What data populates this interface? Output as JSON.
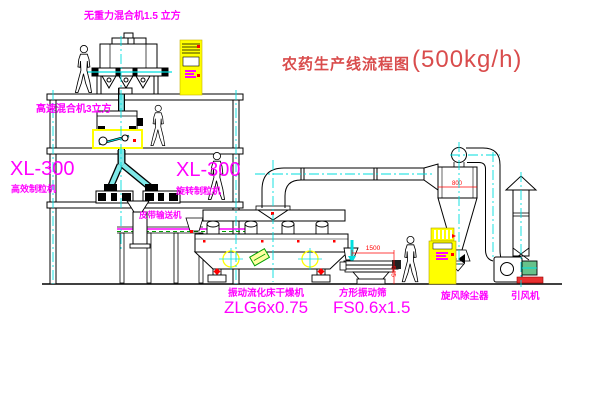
{
  "title": {
    "zh": "农药生产线流程图",
    "capacity": "(500kg/h)"
  },
  "labels": {
    "mixer_top": "无重力混合机1.5 立方",
    "mixer_floor2": "高速混合机3立方",
    "granulator_left_model": "XL-300",
    "granulator_left_name": "高效制粒机",
    "granulator_right_model": "XL-300",
    "granulator_right_name": "旋转制粒机",
    "belt_conveyor": "皮带输送机",
    "dryer_name": "振动流化床干燥机",
    "dryer_model": "ZLG6x0.75",
    "screen_name": "方形振动筛",
    "screen_model": "FS0.6x1.5",
    "cyclone_name": "旋风除尘器",
    "fan_name": "引风机"
  },
  "dimensions": {
    "screen_length": "1500",
    "screen_height": "545",
    "cyclone_dia": "800"
  },
  "colors": {
    "label_magenta": "#ff00ff",
    "title_red": "#d94c4c",
    "centerline_cyan": "#00e0e0",
    "cabinet_yellow": "#ffff00",
    "marker_red": "#ff0000",
    "line_black": "#000000"
  }
}
